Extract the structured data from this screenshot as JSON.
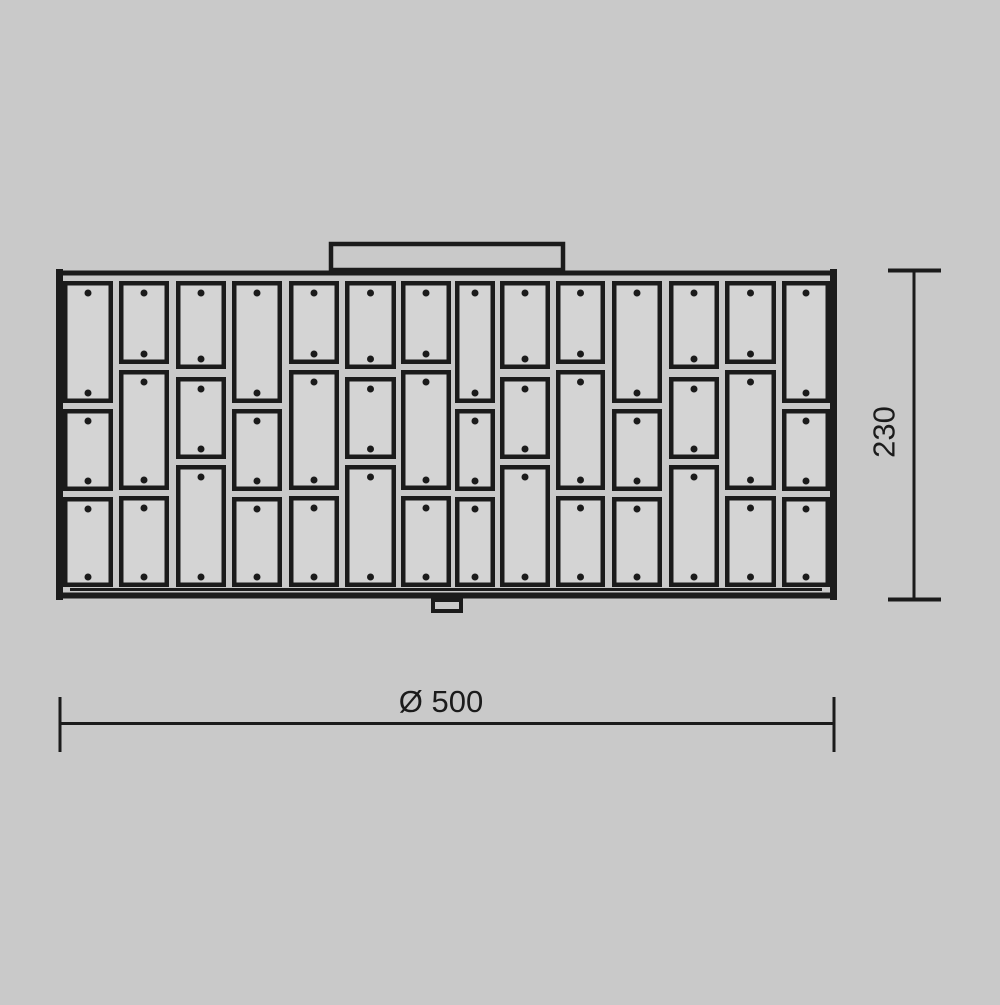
{
  "colors": {
    "background": "#c9c9c9",
    "line": "#1b1b1b",
    "tile_fill": "#d4d4d4"
  },
  "dimensions": {
    "width": {
      "label": "Ø 500",
      "value": 500,
      "symbol": "diameter"
    },
    "height": {
      "label": "230",
      "value": 230
    }
  },
  "drawing": {
    "type": "technical-dimension-drawing",
    "panel": {
      "left": 58,
      "top": 269,
      "right": 837,
      "bottom": 600
    },
    "top_plate": {
      "x": 331,
      "y": 244,
      "width": 232,
      "height": 26
    },
    "bottom_tab": {
      "x": 433,
      "y": 600,
      "width": 28,
      "height": 11
    },
    "tile_patterns": {
      "X": [
        [
          281,
          403
        ],
        [
          409,
          491
        ],
        [
          497,
          587
        ]
      ],
      "Y": [
        [
          281,
          364
        ],
        [
          370,
          490
        ],
        [
          496,
          587
        ]
      ],
      "Z": [
        [
          281,
          369
        ],
        [
          377,
          459
        ],
        [
          465,
          587
        ]
      ]
    },
    "columns": [
      {
        "x": 63,
        "w": 50,
        "pattern": "X"
      },
      {
        "x": 119,
        "w": 50,
        "pattern": "Y"
      },
      {
        "x": 176,
        "w": 50,
        "pattern": "Z"
      },
      {
        "x": 232,
        "w": 50,
        "pattern": "X"
      },
      {
        "x": 289,
        "w": 50,
        "pattern": "Y"
      },
      {
        "x": 345,
        "w": 51,
        "pattern": "Z"
      },
      {
        "x": 401,
        "w": 50,
        "pattern": "Y"
      },
      {
        "x": 455,
        "w": 40,
        "pattern": "X"
      },
      {
        "x": 500,
        "w": 50,
        "pattern": "Z"
      },
      {
        "x": 556,
        "w": 49,
        "pattern": "Y"
      },
      {
        "x": 612,
        "w": 50,
        "pattern": "X"
      },
      {
        "x": 669,
        "w": 50,
        "pattern": "Z"
      },
      {
        "x": 725,
        "w": 51,
        "pattern": "Y"
      },
      {
        "x": 782,
        "w": 48,
        "pattern": "X"
      }
    ],
    "dot": {
      "radius": 3.5,
      "top_offset": 12,
      "bottom_offset": 10
    }
  }
}
